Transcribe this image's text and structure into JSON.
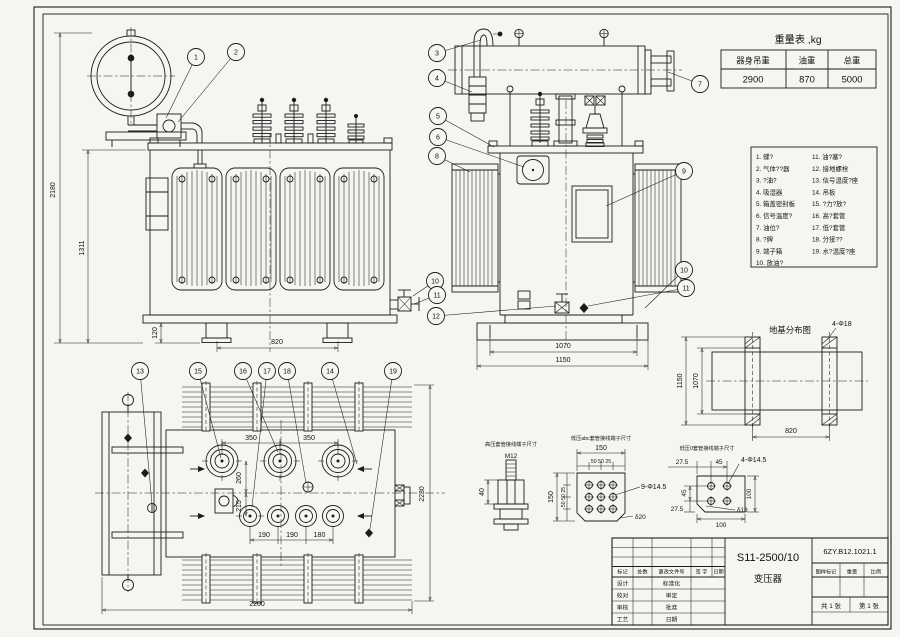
{
  "weight_table": {
    "title": "重量表 ,kg",
    "headers": [
      "器身吊重",
      "油重",
      "总重"
    ],
    "values": [
      "2900",
      "870",
      "5000"
    ]
  },
  "parts_list": {
    "left": [
      "1. 蝶?",
      "2. 气体??器",
      "3. ?油?",
      "4. 吸湿器",
      "5. 箱盖密封板",
      "6. 信号温度?",
      "7. 油位?",
      "8. ?牌",
      "9. 端子箱",
      "10. 放油?"
    ],
    "right": [
      "11. 油?塞?",
      "12. 接地螺栓",
      "13. 信号温度?座",
      "14. 吊板",
      "15. ?力?放?",
      "16. 高?套管",
      "17. 低?套管",
      "18. 分接??",
      "19. 水?温度?座"
    ]
  },
  "balloons": {
    "b1": "1",
    "b2": "2",
    "b3": "3",
    "b4": "4",
    "b5": "5",
    "b6": "6",
    "b7": "7",
    "b8": "8",
    "b9": "9",
    "b10": "10",
    "b11": "11",
    "b12": "12",
    "b13": "13",
    "b14": "14",
    "b15": "15",
    "b16": "16",
    "b17": "17",
    "b18": "18",
    "b19": "19"
  },
  "front_view": {
    "d_total_h": "2180",
    "d_tank_h": "1311",
    "d_base_h": "120",
    "d_skid": "820"
  },
  "side_view": {
    "d_inner": "1070",
    "d_outer": "1150"
  },
  "top_view": {
    "d_hv1": "350",
    "d_hv2": "350",
    "d_260": "260",
    "d_215": "215",
    "d_lv1": "190",
    "d_lv2": "190",
    "d_lv3": "180",
    "d_w": "2200",
    "d_h": "2230"
  },
  "foundation": {
    "title": "地基分布图",
    "bolt": "4-Φ18",
    "d_outer": "1150",
    "d_inner": "1070",
    "d_span": "820"
  },
  "hv_terminal": {
    "label": "高压套管接线端子尺寸",
    "thread": "M12",
    "d_h": "40"
  },
  "lv_abc_terminal": {
    "label": "低压abc套管接线端子尺寸",
    "d_w": "150",
    "sp_t": "50 50 25",
    "d_h": "150",
    "sp_l": "50 50 25",
    "holes": "9-Φ14.5",
    "thk": "δ20"
  },
  "lv_o_terminal": {
    "label": "低压0套管接线端子尺寸",
    "d_275t": "27.5",
    "d_45t": "45",
    "holes": "4-Φ14.5",
    "d_45l": "45",
    "d_275l": "27.5",
    "d_100r": "100",
    "d_100b": "100",
    "thk": "δ18"
  },
  "title_block": {
    "model": "S11-2500/10",
    "product": "变压器",
    "doc_no": "6ZY.B12.1021.1",
    "h_mark": "图样标记",
    "h_weight": "重量",
    "h_scale": "比例",
    "sheet_l": "共 1 张",
    "sheet_r": "第 1 张",
    "r_mark": "标记",
    "r_count": "处数",
    "r_doc": "更改文件号",
    "r_sign": "签 字",
    "r_date": "日期",
    "l1": "设计",
    "l2": "校对",
    "l3": "审核",
    "l4": "工艺",
    "m1": "标准化",
    "m2": "审定",
    "m3": "批准",
    "m4": "日期"
  }
}
